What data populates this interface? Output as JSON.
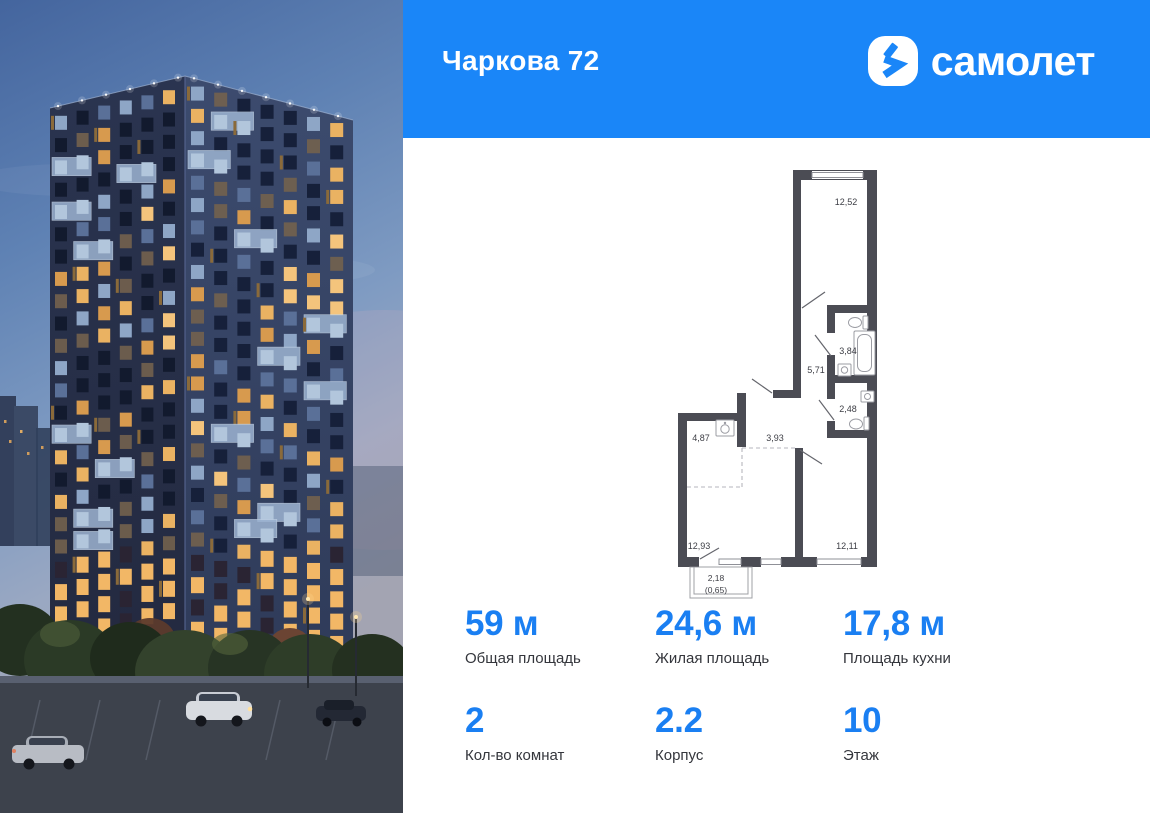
{
  "theme": {
    "brand_blue": "#1a86f8",
    "accent_blue": "#1a7ff2"
  },
  "header": {
    "title": "Чаркова 72",
    "brand": "самолет"
  },
  "plan": {
    "rooms": [
      {
        "id": "room-top",
        "label": "12,52"
      },
      {
        "id": "bathroom",
        "label": "3,84"
      },
      {
        "id": "hallway",
        "label": "5,71"
      },
      {
        "id": "wc",
        "label": "2,48"
      },
      {
        "id": "kitchen",
        "label": "4,87"
      },
      {
        "id": "hall",
        "label": "3,93"
      },
      {
        "id": "living",
        "label": "12,93"
      },
      {
        "id": "bedroom",
        "label": "12,11"
      },
      {
        "id": "balcony",
        "label": "2,18",
        "label2": "(0,65)"
      }
    ]
  },
  "stats": {
    "row1": [
      {
        "value": "59 м",
        "label": "Общая площадь"
      },
      {
        "value": "24,6 м",
        "label": "Жилая площадь"
      },
      {
        "value": "17,8 м",
        "label": "Площадь кухни"
      }
    ],
    "row2": [
      {
        "value": "2",
        "label": "Кол-во комнат"
      },
      {
        "value": "2.2",
        "label": "Корпус"
      },
      {
        "value": "10",
        "label": "Этаж"
      }
    ]
  }
}
